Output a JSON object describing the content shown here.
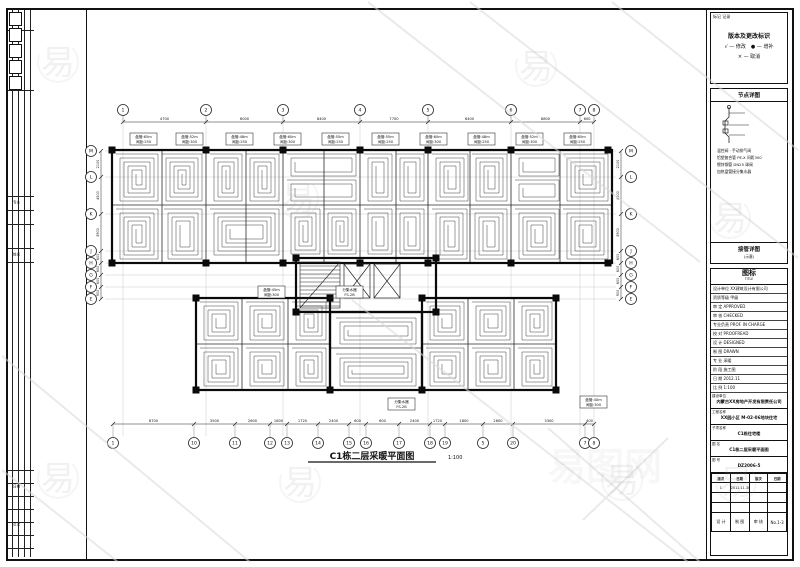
{
  "sheet": {
    "line_color": "#111111",
    "coil_color": "#3f3f3f",
    "grid_color": "#b5b5b5"
  },
  "watermark": {
    "glyph": "易",
    "site_name": "易图网",
    "color": "#9a9a9a",
    "marks": [
      [
        58,
        62
      ],
      [
        298,
        198
      ],
      [
        536,
        66
      ],
      [
        730,
        218
      ],
      [
        58,
        478
      ],
      [
        300,
        482
      ],
      [
        622,
        480
      ],
      [
        736,
        482
      ]
    ],
    "site_pos": [
      548,
      480
    ]
  },
  "left_strip": {
    "band1": [
      "专业",
      "姓名"
    ],
    "band2": [
      "日期",
      "页次"
    ]
  },
  "plan": {
    "title": {
      "text": "C1栋二层采暖平面图",
      "scale": "1:100"
    },
    "axes_top": {
      "bubble_y": 110,
      "dim_y": 122,
      "x": [
        123,
        206,
        283,
        360,
        428,
        511,
        580,
        594
      ],
      "labels": [
        "1",
        "2",
        "3",
        "4",
        "5",
        "6",
        "7",
        "8"
      ],
      "dims": [
        "4700",
        "6000",
        "8400",
        "7700",
        "6400",
        "8800",
        "600"
      ]
    },
    "axes_bottom": {
      "bubble_y": 443,
      "dim_y": 424,
      "x": [
        113,
        194,
        235,
        270,
        287,
        318,
        349,
        366,
        399,
        430,
        445,
        483,
        513,
        585,
        594
      ],
      "labels": [
        "1",
        "10",
        "11",
        "12",
        "13",
        "14",
        "15",
        "16",
        "17",
        "18",
        "19",
        "5",
        "20",
        "7",
        "8"
      ],
      "dims": [
        "8700",
        "3500",
        "2600",
        "1800",
        "1720",
        "2400",
        "600",
        "600",
        "2400",
        "1720",
        "1800",
        "2600",
        "3300",
        "400"
      ]
    },
    "axes_left": {
      "bubble_x": 91,
      "dim_x": 101,
      "y": [
        151,
        177,
        214,
        251,
        263,
        275,
        287,
        299
      ],
      "labels": [
        "M",
        "L",
        "K",
        "J",
        "H",
        "G",
        "F",
        "E"
      ],
      "dims": [
        "2100",
        "4500",
        "3900",
        "600",
        "600",
        "600",
        "900"
      ]
    },
    "axes_right": {
      "bubble_x": 631,
      "dim_x": 621,
      "y": [
        151,
        177,
        214,
        251,
        263,
        275,
        287,
        299
      ],
      "labels": [
        "M",
        "L",
        "K",
        "J",
        "H",
        "G",
        "F",
        "E"
      ],
      "dims": [
        "2100",
        "4500",
        "3900",
        "600",
        "600",
        "600",
        "900"
      ]
    },
    "walls_thick": [
      [
        112,
        150,
        500,
        113
      ],
      [
        196,
        298,
        134,
        92
      ],
      [
        422,
        298,
        134,
        92
      ],
      [
        296,
        258,
        140,
        54
      ],
      [
        330,
        312,
        92,
        78
      ]
    ],
    "walls_thin": [
      [
        206,
        150,
        206,
        263
      ],
      [
        283,
        150,
        283,
        263
      ],
      [
        360,
        150,
        360,
        263
      ],
      [
        428,
        150,
        428,
        263
      ],
      [
        511,
        150,
        511,
        263
      ],
      [
        162,
        150,
        162,
        263
      ],
      [
        246,
        150,
        246,
        263
      ],
      [
        324,
        150,
        324,
        263
      ],
      [
        396,
        150,
        396,
        263
      ],
      [
        470,
        150,
        470,
        263
      ],
      [
        560,
        150,
        560,
        263
      ],
      [
        112,
        205,
        612,
        205
      ],
      [
        242,
        298,
        242,
        390
      ],
      [
        288,
        298,
        288,
        390
      ],
      [
        196,
        344,
        330,
        344
      ],
      [
        468,
        298,
        468,
        390
      ],
      [
        514,
        298,
        514,
        390
      ],
      [
        422,
        344,
        556,
        344
      ],
      [
        330,
        348,
        422,
        348
      ]
    ],
    "columns": [
      [
        112,
        150
      ],
      [
        206,
        150
      ],
      [
        283,
        150
      ],
      [
        360,
        150
      ],
      [
        428,
        150
      ],
      [
        511,
        150
      ],
      [
        608,
        150
      ],
      [
        112,
        263
      ],
      [
        206,
        263
      ],
      [
        283,
        263
      ],
      [
        360,
        263
      ],
      [
        428,
        263
      ],
      [
        511,
        263
      ],
      [
        608,
        263
      ],
      [
        196,
        298
      ],
      [
        330,
        298
      ],
      [
        422,
        298
      ],
      [
        556,
        298
      ],
      [
        196,
        390
      ],
      [
        330,
        390
      ],
      [
        422,
        390
      ],
      [
        556,
        390
      ],
      [
        296,
        258
      ],
      [
        436,
        258
      ],
      [
        296,
        312
      ],
      [
        436,
        312
      ]
    ],
    "coils": [
      [
        116,
        154,
        42,
        47
      ],
      [
        162,
        154,
        40,
        47
      ],
      [
        116,
        209,
        42,
        50
      ],
      [
        164,
        209,
        38,
        50
      ],
      [
        210,
        154,
        32,
        47
      ],
      [
        246,
        154,
        33,
        47
      ],
      [
        210,
        209,
        69,
        46
      ],
      [
        287,
        154,
        69,
        22
      ],
      [
        287,
        180,
        69,
        21
      ],
      [
        287,
        209,
        33,
        45
      ],
      [
        324,
        209,
        32,
        45
      ],
      [
        364,
        154,
        28,
        47
      ],
      [
        396,
        154,
        28,
        47
      ],
      [
        364,
        209,
        28,
        45
      ],
      [
        396,
        209,
        28,
        45
      ],
      [
        432,
        154,
        36,
        47
      ],
      [
        472,
        154,
        35,
        47
      ],
      [
        432,
        209,
        35,
        50
      ],
      [
        471,
        209,
        36,
        50
      ],
      [
        515,
        154,
        44,
        22
      ],
      [
        515,
        180,
        44,
        21
      ],
      [
        563,
        154,
        45,
        47
      ],
      [
        515,
        209,
        44,
        50
      ],
      [
        563,
        209,
        45,
        50
      ],
      [
        200,
        302,
        38,
        38
      ],
      [
        246,
        302,
        38,
        38
      ],
      [
        292,
        302,
        34,
        38
      ],
      [
        200,
        348,
        38,
        38
      ],
      [
        246,
        348,
        38,
        38
      ],
      [
        292,
        348,
        34,
        38
      ],
      [
        426,
        302,
        38,
        38
      ],
      [
        472,
        302,
        38,
        38
      ],
      [
        518,
        302,
        34,
        38
      ],
      [
        426,
        348,
        38,
        38
      ],
      [
        472,
        348,
        38,
        38
      ],
      [
        518,
        348,
        34,
        38
      ],
      [
        336,
        318,
        80,
        26
      ],
      [
        336,
        354,
        80,
        32
      ]
    ],
    "stairs": [
      [
        300,
        262,
        40,
        46
      ]
    ],
    "elevators": [
      [
        344,
        264,
        26,
        34
      ],
      [
        374,
        264,
        26,
        34
      ]
    ],
    "info_boxes": [
      [
        130,
        133,
        "盘管:65m",
        "间距:250"
      ],
      [
        176,
        133,
        "盘管:52m",
        "间距:300"
      ],
      [
        226,
        133,
        "盘管:48m",
        "间距:250"
      ],
      [
        274,
        133,
        "盘管:60m",
        "间距:300"
      ],
      [
        322,
        133,
        "盘管:55m",
        "间距:250"
      ],
      [
        372,
        133,
        "盘管:55m",
        "间距:250"
      ],
      [
        420,
        133,
        "盘管:60m",
        "间距:300"
      ],
      [
        468,
        133,
        "盘管:48m",
        "间距:250"
      ],
      [
        516,
        133,
        "盘管:52m",
        "间距:300"
      ],
      [
        564,
        133,
        "盘管:65m",
        "间距:250"
      ],
      [
        258,
        286,
        "盘管:45m",
        "间距:300"
      ],
      [
        336,
        286,
        "分集水器",
        "FS-2B"
      ],
      [
        388,
        398,
        "分集水器",
        "FS-2B"
      ],
      [
        580,
        396,
        "盘管:40m",
        "间距:300"
      ]
    ]
  },
  "right_panel": {
    "legend": {
      "corner": "标记 记录",
      "title": "版本及更改标识",
      "rows": [
        "√ — 修改　● — 增补",
        "× — 取消"
      ]
    },
    "detail": {
      "header": "节点详图",
      "lines": [
        "温控阀 · 手动排气阀",
        "铝塑复合管 PE-X 间距300",
        "镀锌钢管 DN25 球阀",
        "加热盘管接分集水器"
      ],
      "footer": "接管详图",
      "footer_sub": "(示意)"
    },
    "title_block": {
      "header": "图标",
      "header_sub": "TITLE",
      "rows": [
        "设计单位  XX建筑设计有限公司",
        "资质等级  甲级",
        "审 定  APPROVED",
        "审 核  CHECKED",
        "专业负责  PROF. IN CHARGE",
        "校 对  PROOFREAD",
        "设 计  DESIGNED",
        "制 图  DRAWN",
        "专 业  采暖",
        "阶 段  施工图",
        "日 期  2012.11",
        "比 例  1:100"
      ],
      "fields": [
        {
          "label": "建设单位",
          "value": "内蒙古XX房地产开发有限责任公司"
        },
        {
          "label": "工程名称",
          "value": "XX园小区 M-02-06地块住宅"
        },
        {
          "label": "子项名称",
          "value": "C1栋住宅楼"
        },
        {
          "label": "图 名",
          "value": "C1栋二层采暖平面图"
        },
        {
          "label": "图 号",
          "value": "DZ2006-5"
        }
      ],
      "version_table": {
        "headers": [
          "版次",
          "日期",
          "版次",
          "日期"
        ],
        "rows": [
          [
            "1",
            "2012.11.30",
            "",
            ""
          ],
          [
            "",
            "",
            "",
            ""
          ],
          [
            "",
            "",
            "",
            ""
          ]
        ],
        "bottom": [
          "设 计",
          "制 图",
          "审 核",
          "No.1-3"
        ]
      }
    }
  }
}
